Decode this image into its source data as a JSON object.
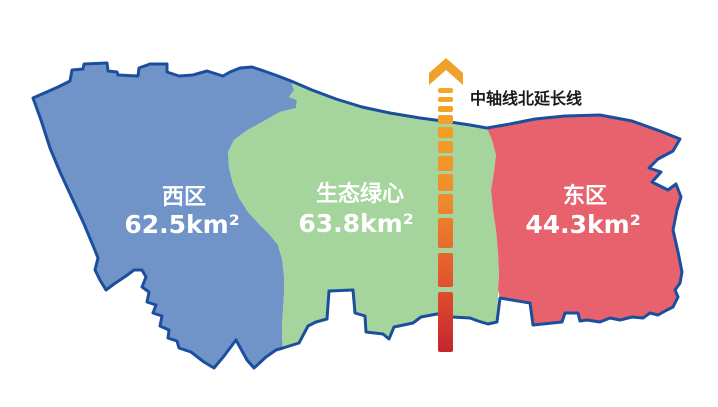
{
  "map": {
    "background": "#FFFFFF",
    "border_color": "#1B4F9E",
    "label_color": "#FFFFFF"
  },
  "regions": [
    {
      "name": "西区",
      "area": "62.5km²",
      "fill": "#7093C8"
    },
    {
      "name": "生态绿心",
      "area": "63.8km²",
      "fill": "#A5D49D"
    },
    {
      "name": "东区",
      "area": "44.3km²",
      "fill": "#E7626D"
    }
  ],
  "axis": {
    "label": "中轴线北延长线",
    "label_color": "#1A1A1A",
    "arrow_color": "#F0A12C",
    "gradient_top": "#F5A828",
    "gradient_mid": "#EE8C2C",
    "gradient_deep": "#E2532E",
    "gradient_bottom": "#C4252E"
  }
}
